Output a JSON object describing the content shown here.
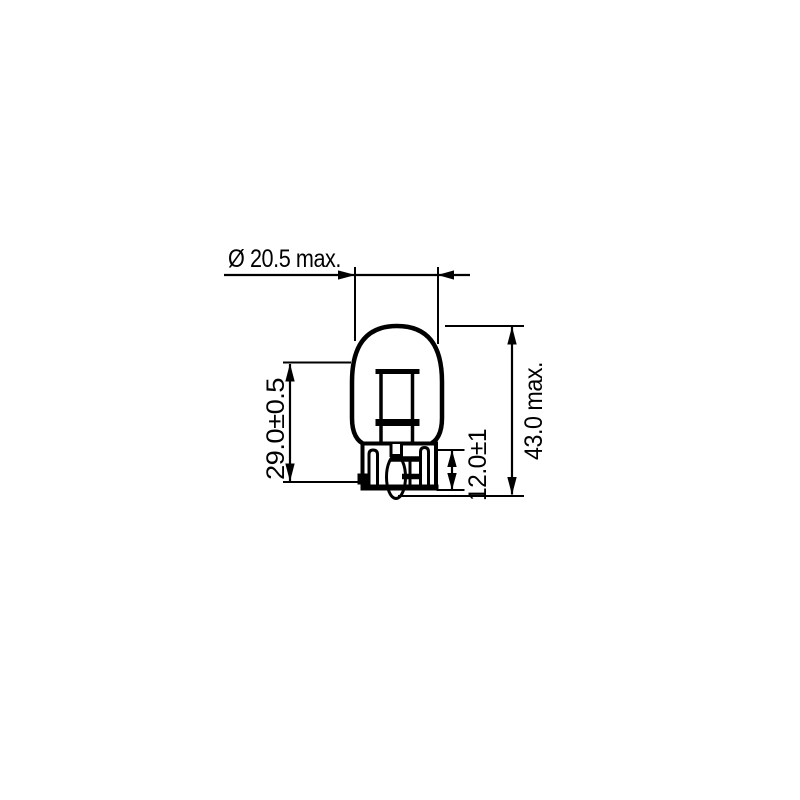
{
  "diagram": {
    "subject": "wedge-base bulb dimensional drawing",
    "background_color": "#ffffff",
    "line_color": "#000000",
    "dimensions": {
      "diameter": "Ø 20.5 max.",
      "glass_height": "29.0±0.5",
      "base_height": "12.0±1",
      "overall_height": "43.0 max."
    }
  }
}
